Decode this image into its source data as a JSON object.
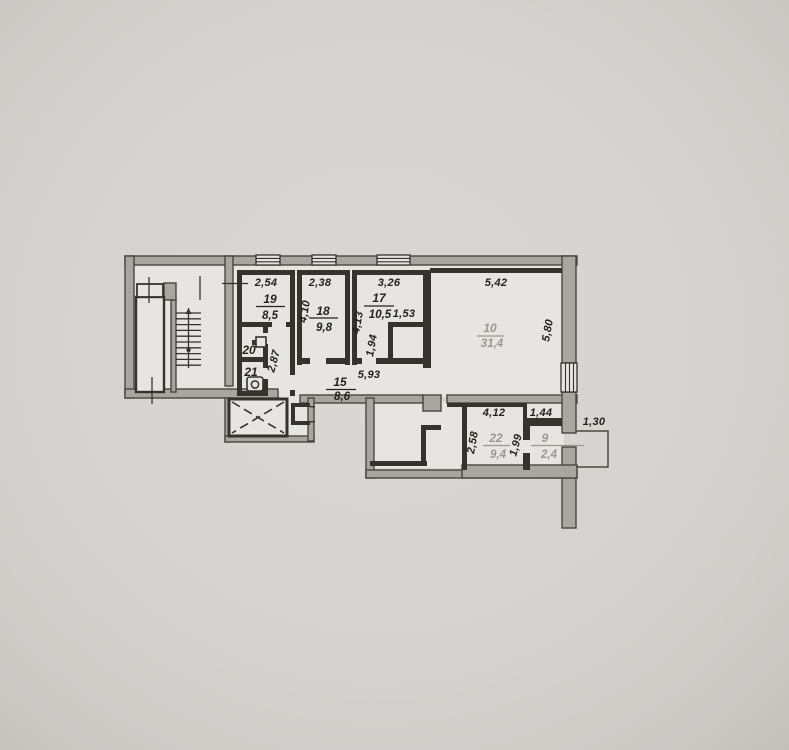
{
  "document": {
    "kind": "scanned apartment floor plan (BTI technical drawing)"
  },
  "colors": {
    "paper": "#d8d6d2",
    "paper_edge": "#c3c0bc",
    "floor": "#e7e5e1",
    "wall_fill": "#a9a6a1",
    "wall_stroke": "#4a463f",
    "wall_dark": "#36332e",
    "label_black": "#26231e",
    "label_grey": "#9b9791"
  },
  "plan": {
    "rooms": {
      "r19": {
        "number": "19",
        "area": "8,5"
      },
      "r18": {
        "number": "18",
        "area": "9,8"
      },
      "r17": {
        "number": "17",
        "area": "10,5"
      },
      "r15": {
        "number": "15",
        "area": "8,6"
      },
      "r10": {
        "number": "10",
        "area": "31,4"
      },
      "r20": {
        "number": "20"
      },
      "r21": {
        "number": "21"
      },
      "r22": {
        "number": "22",
        "area": "9,4"
      },
      "r9": {
        "number": "9",
        "area": "2,4"
      }
    },
    "dims": {
      "w19": "2,54",
      "w18": "2,38",
      "w17": "3,26",
      "w10": "5,42",
      "h18": "4,10",
      "h17": "4,13",
      "closet_w": "1,53",
      "closet_h": "1,94",
      "h10": "5,80",
      "hall_h": "2,87",
      "corr_len": "5,93",
      "w22": "4,12",
      "w9": "1,44",
      "balcony_w": "1,30",
      "h22_left": "2,58",
      "h22_right": "1,99"
    }
  }
}
